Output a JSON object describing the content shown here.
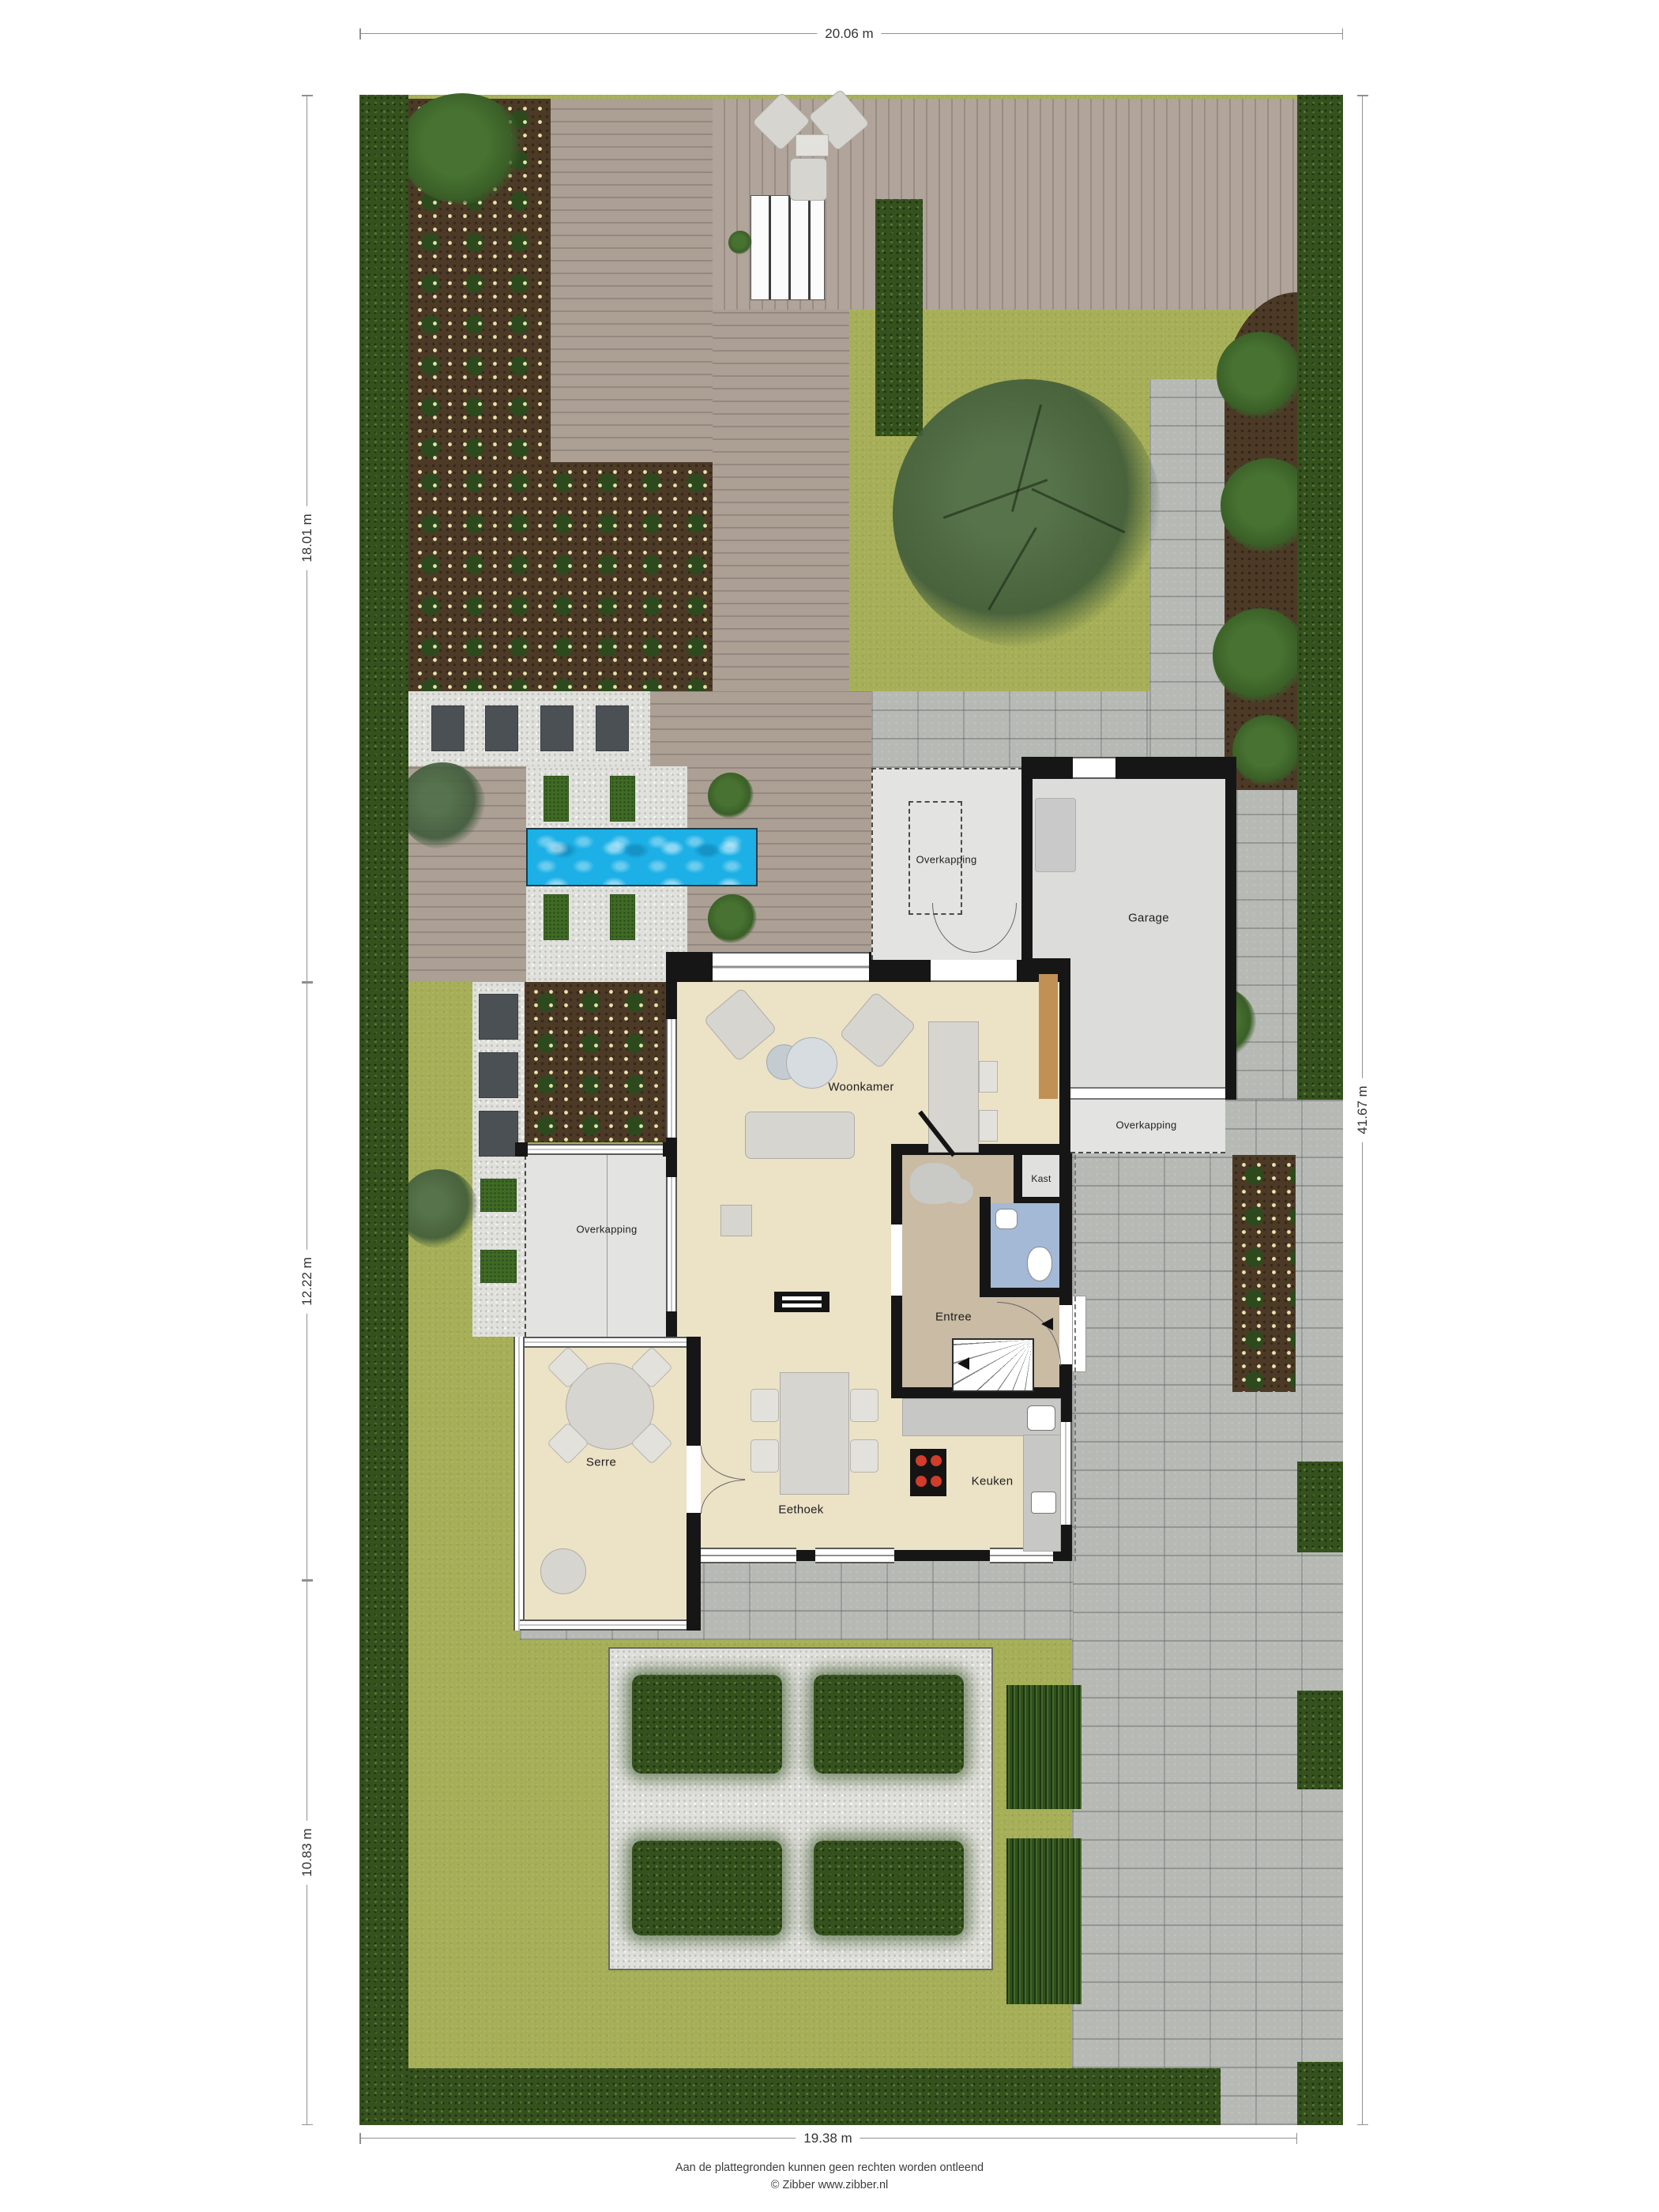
{
  "dimensions": {
    "top": "20.06 m",
    "left_top": "18.01 m",
    "left_middle": "12.22 m",
    "left_bottom": "10.83 m",
    "right": "41.67 m",
    "bottom": "19.38 m"
  },
  "rooms": {
    "woonkamer": "Woonkamer",
    "garage": "Garage",
    "overkapping": "Overkapping",
    "kast": "Kast",
    "entree": "Entree",
    "serre": "Serre",
    "eethoek": "Eethoek",
    "keuken": "Keuken"
  },
  "footer": {
    "disclaimer": "Aan de plattegronden kunnen geen rechten worden ontleend",
    "copyright": "© Zibber www.zibber.nl"
  },
  "colors": {
    "lawn": "#a6af57",
    "hedge": "#35521e",
    "soil": "#4c3a27",
    "deck": "#a79a91",
    "gravel": "#e0e0dc",
    "pavers": "#b7b9b5",
    "pool": "#1cb0e6",
    "floor_living": "#ece2c6",
    "floor_entree": "#c9bba4",
    "floor_toilet": "#a3b9d6",
    "floor_garage": "#dcdcdb",
    "wall": "#161616"
  }
}
